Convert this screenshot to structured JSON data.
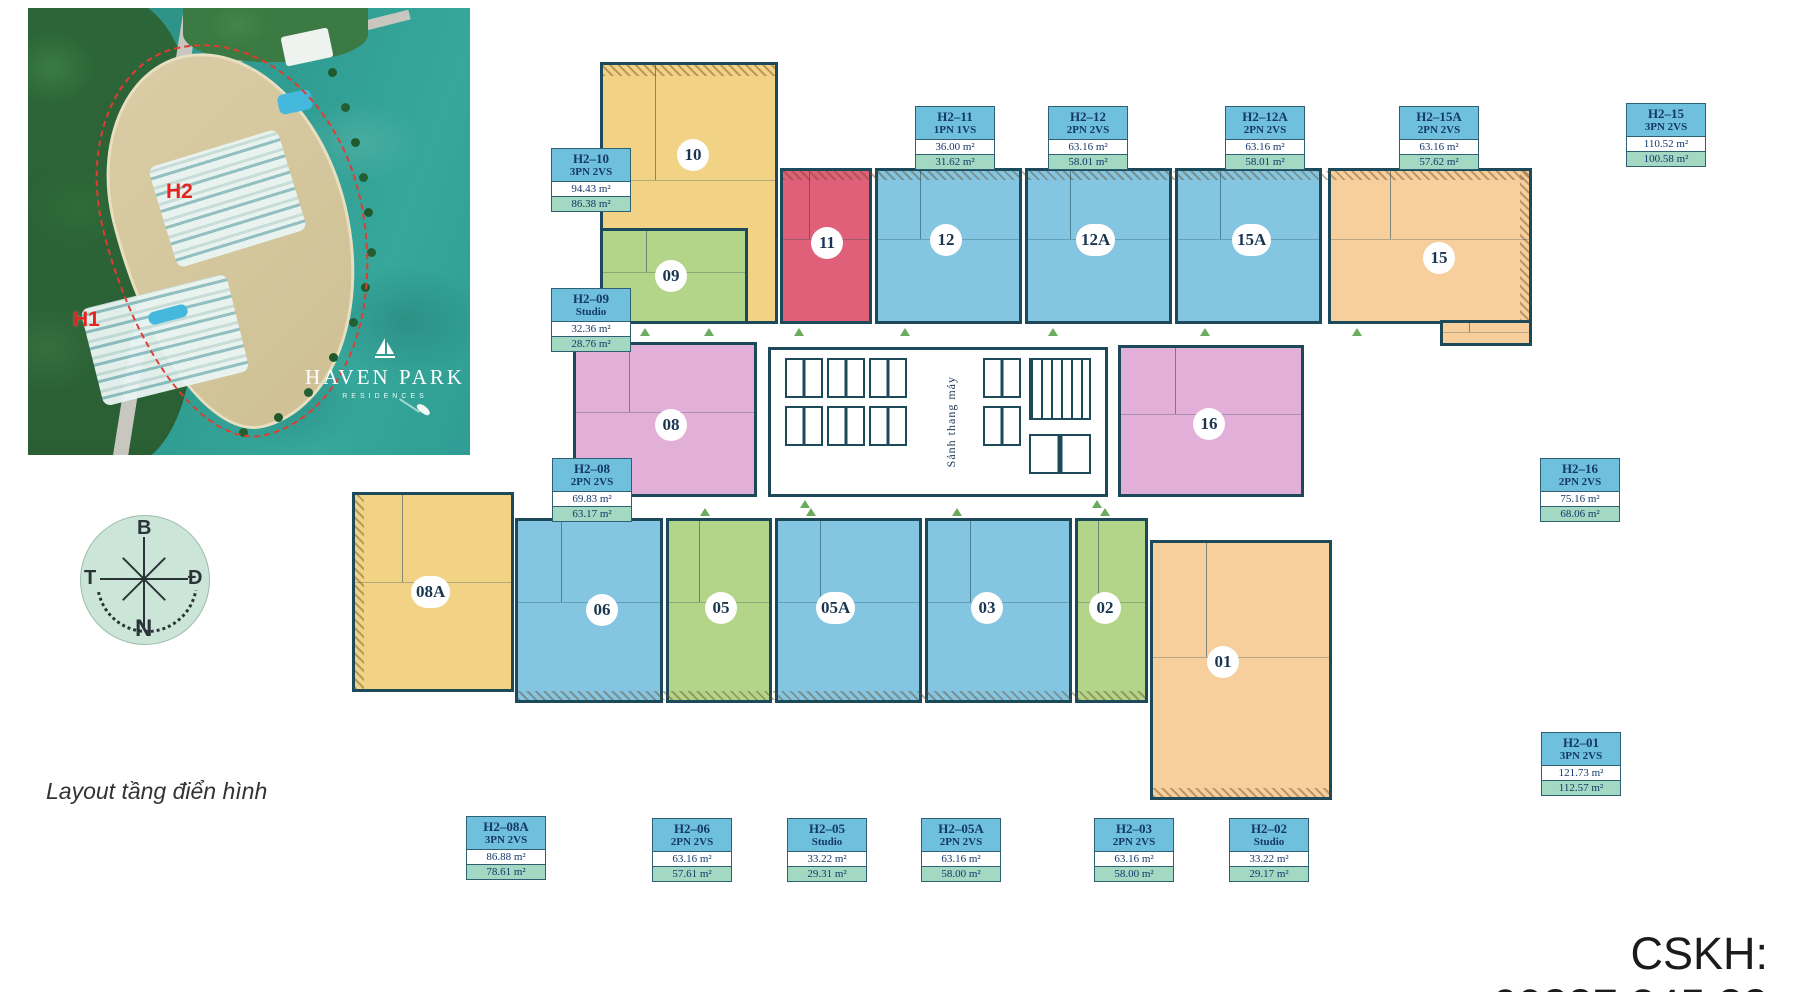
{
  "page": {
    "background": "#FFFFFF",
    "caption": "Layout tầng điển hình",
    "hotline": "CSKH: 09887.345.88"
  },
  "map": {
    "area_labels": [
      {
        "text": "H2"
      },
      {
        "text": "H1"
      }
    ],
    "logo": {
      "title": "HAVEN PARK",
      "subtitle": "RESIDENCES"
    }
  },
  "compass": {
    "north": "B",
    "east": "Đ",
    "south": "N",
    "west": "T"
  },
  "floor_plan": {
    "core_label": "Sảnh thang máy",
    "colors": {
      "info_header_bg": "#6FC0DC",
      "info_net_bg": "#A3D8C2",
      "info_text": "#14386A",
      "wall": "#1D4A5A",
      "door_marker": "#6BAB5E"
    },
    "units": [
      {
        "number": "10",
        "code": "H2–10",
        "type": "3PN 2VS",
        "gross": "94.43 m²",
        "net": "86.38 m²",
        "color": "#F2D386"
      },
      {
        "number": "09",
        "code": "H2–09",
        "type": "Studio",
        "gross": "32.36 m²",
        "net": "28.76 m²",
        "color": "#B3D589"
      },
      {
        "number": "11",
        "code": "H2–11",
        "type": "1PN 1VS",
        "gross": "36.00 m²",
        "net": "31.62 m²",
        "color": "#E06079"
      },
      {
        "number": "12",
        "code": "H2–12",
        "type": "2PN 2VS",
        "gross": "63.16 m²",
        "net": "58.01 m²",
        "color": "#84C5E1"
      },
      {
        "number": "12A",
        "code": "H2–12A",
        "type": "2PN 2VS",
        "gross": "63.16 m²",
        "net": "58.01 m²",
        "color": "#84C5E1"
      },
      {
        "number": "15A",
        "code": "H2–15A",
        "type": "2PN 2VS",
        "gross": "63.16 m²",
        "net": "57.62 m²",
        "color": "#84C5E1"
      },
      {
        "number": "15",
        "code": "H2–15",
        "type": "3PN 2VS",
        "gross": "110.52 m²",
        "net": "100.58 m²",
        "color": "#F6CF9C"
      },
      {
        "number": "08",
        "code": "H2–08",
        "type": "2PN 2VS",
        "gross": "69.83 m²",
        "net": "63.17 m²",
        "color": "#E2AFD8"
      },
      {
        "number": "16",
        "code": "H2–16",
        "type": "2PN 2VS",
        "gross": "75.16 m²",
        "net": "68.06 m²",
        "color": "#E2AFD8"
      },
      {
        "number": "08A",
        "code": "H2–08A",
        "type": "3PN 2VS",
        "gross": "86.88 m²",
        "net": "78.61 m²",
        "color": "#F2D386"
      },
      {
        "number": "06",
        "code": "H2–06",
        "type": "2PN 2VS",
        "gross": "63.16 m²",
        "net": "57.61 m²",
        "color": "#84C5E1"
      },
      {
        "number": "05",
        "code": "H2–05",
        "type": "Studio",
        "gross": "33.22 m²",
        "net": "29.31 m²",
        "color": "#B3D589"
      },
      {
        "number": "05A",
        "code": "H2–05A",
        "type": "2PN 2VS",
        "gross": "63.16 m²",
        "net": "58.00 m²",
        "color": "#84C5E1"
      },
      {
        "number": "03",
        "code": "H2–03",
        "type": "2PN 2VS",
        "gross": "63.16 m²",
        "net": "58.00 m²",
        "color": "#84C5E1"
      },
      {
        "number": "02",
        "code": "H2–02",
        "type": "Studio",
        "gross": "33.22 m²",
        "net": "29.17 m²",
        "color": "#B3D589"
      },
      {
        "number": "01",
        "code": "H2–01",
        "type": "3PN 2VS",
        "gross": "121.73 m²",
        "net": "112.57 m²",
        "color": "#F6CF9C"
      }
    ]
  }
}
